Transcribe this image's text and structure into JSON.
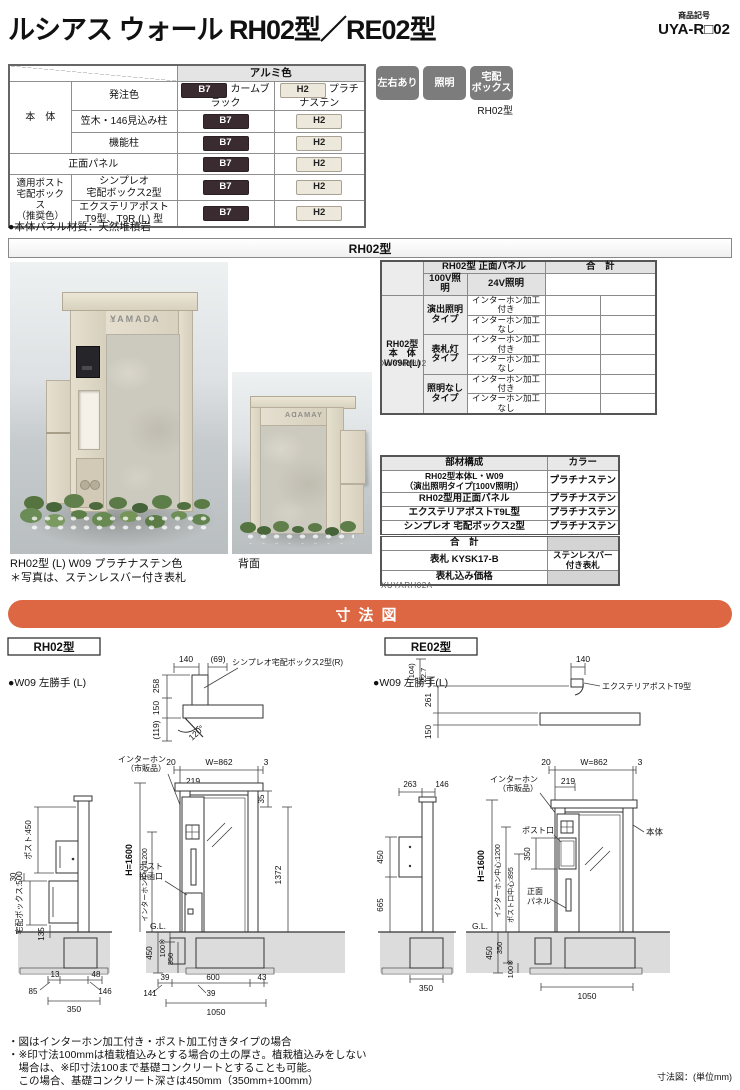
{
  "header": {
    "title": "ルシアス ウォール RH02型／RE02型",
    "code_label": "商品記号",
    "code": "UYA-R□02"
  },
  "colors": {
    "b7": {
      "code": "B7",
      "name": "カームブラック",
      "hex": "#3a2b31"
    },
    "h2": {
      "code": "H2",
      "name": "プラチナステン",
      "hex": "#ece8db"
    },
    "accent_orange": "#dc6742",
    "badge_gray": "#7c7c7c"
  },
  "color_table": {
    "header": "アルミ色",
    "order_row": "発注色",
    "group_body": "本　体",
    "rows_body": [
      "笠木・146見込み柱",
      "機能柱"
    ],
    "front_panel": "正面パネル",
    "group_post": "適用ポスト\n宅配ボックス\n（推奨色）",
    "rows_post": [
      "シンプレオ\n宅配ボックス2型",
      "エクステリアポスト\nT9型、T9R (L) 型"
    ]
  },
  "feature_badges": [
    "左右あり",
    "照明",
    "宅配\nボックス"
  ],
  "badge_model": "RH02型",
  "material_note": "●本体パネル材質：天然堆積岩",
  "section_rh02": "RH02型",
  "price_table": {
    "header_product": "RH02型 正面パネル",
    "header_total": "合　計",
    "cols": [
      "100V照明",
      "24V照明"
    ],
    "body_label": "RH02型\n本　体\nW09R(L)",
    "types": [
      "演出照明\nタイプ",
      "表札灯\nタイプ",
      "照明なし\nタイプ"
    ],
    "opt_with": "インターホン加工付き",
    "opt_without": "インターホン加工なし",
    "caption": "XUYARH02"
  },
  "parts_table": {
    "headers": [
      "部材構成",
      "カラー"
    ],
    "rows": [
      {
        "name": "RH02型本体L・W09\n（演出照明タイプ[100V照明]）",
        "color": "プラチナステン"
      },
      {
        "name": "RH02型用正面パネル",
        "color": "プラチナステン"
      },
      {
        "name": "エクステリアポストT9L型",
        "color": "プラチナステン"
      },
      {
        "name": "シンプレオ 宅配ボックス2型",
        "color": "プラチナステン"
      },
      {
        "name": "合　計",
        "color": ""
      },
      {
        "name": "表札 KYSK17-B",
        "color": "ステンレスバー\n付き表札"
      },
      {
        "name": "表札込み価格",
        "color": ""
      }
    ],
    "caption": "XUYARH02A"
  },
  "photos": {
    "house_icon": "⌂",
    "nameplate": "YAMADA",
    "caption1": "RH02型 (L) W09 プラチナステン色",
    "caption2": "＊写真は、ステンレスバー付き表札",
    "caption_back": "背面"
  },
  "dim_section": {
    "title": "寸法図",
    "unit": "寸法図：(単位mm)"
  },
  "rh02_dim": {
    "model": "RH02型",
    "hand": "●W09 左勝手 (L)",
    "plan": {
      "d140": "140",
      "d69": "(69)",
      "post": "シンプレオ宅配ボックス2型(R)",
      "d258": "258",
      "d150": "150",
      "d119": "(119)",
      "angle": "120°"
    },
    "side": {
      "post450": "ポスト:450",
      "d30": "30",
      "box500": "宅配ボックス:500",
      "d135": "135",
      "d13": "13",
      "d48": "48",
      "d85": "85",
      "d146": "146",
      "d350": "350"
    },
    "front": {
      "d20": "20",
      "w862": "W=862",
      "d3": "3",
      "d219": "219",
      "ip1": "インターホン",
      "ip2": "（市販品）",
      "ps1": "ポスト",
      "ps2": "投函口",
      "d35": "35",
      "h1600": "H=1600",
      "ic1200": "インターホン中心:1200",
      "d1372": "1372",
      "gl": "G.L.",
      "d450": "450",
      "d100": "100※",
      "d350": "350",
      "b39a": "39",
      "b600": "600",
      "b43": "43",
      "b141": "141",
      "b39b": "39",
      "b1050": "1050"
    }
  },
  "re02_dim": {
    "model": "RE02型",
    "hand": "●W09 左勝手(L)",
    "plan": {
      "d104": "(104)",
      "d227": "22.7",
      "d140": "140",
      "post": "エクステリアポストT9型",
      "d261": "261",
      "d150": "150"
    },
    "side": {
      "d263": "263",
      "d146": "146",
      "d450": "450",
      "d665": "665",
      "d350": "350"
    },
    "front": {
      "d20": "20",
      "w862": "W=862",
      "d3": "3",
      "d219": "219",
      "ip1": "インターホン",
      "ip2": "（市販品）",
      "post_slot": "ポスト口",
      "d350": "350",
      "body": "本体",
      "pn1": "正面",
      "pn2": "パネル",
      "h1600": "H=1600",
      "ic1200": "インターホン中心:1200",
      "pc895": "ポスト口中心:895",
      "gl": "G.L.",
      "d450": "450",
      "g350": "350",
      "d100": "100※",
      "b1050": "1050"
    }
  },
  "notes": [
    "・図はインターホン加工付き・ポスト加工付きタイプの場合",
    "・※印寸法100mmは植栽植込みとする場合の土の厚さ。植栽植込みをしない",
    "　場合は、※印寸法100まで基礎コンクリートとすることも可能。",
    "　この場合、基礎コンクリート深さは450mm（350mm+100mm）"
  ]
}
